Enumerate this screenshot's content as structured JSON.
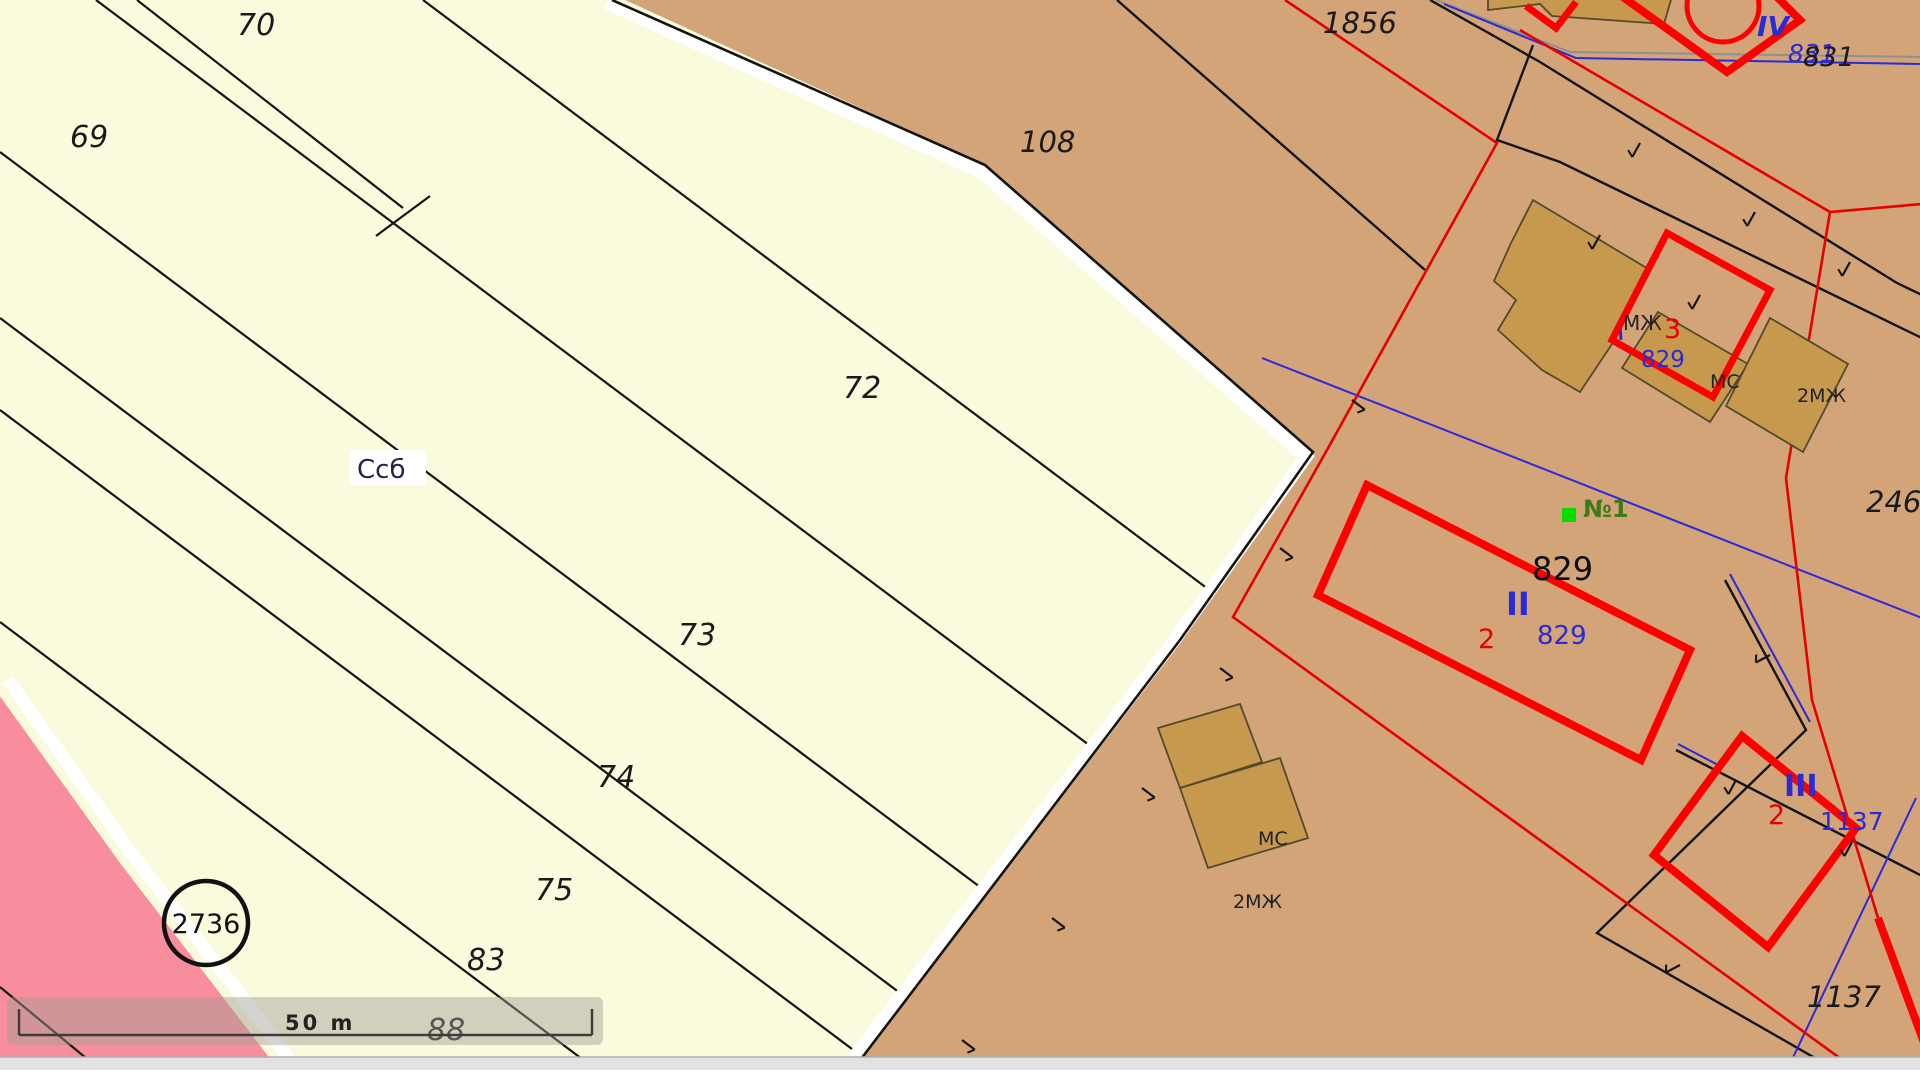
{
  "map": {
    "colors": {
      "cream": "#FAFADC",
      "brown": "#D2A478",
      "pink": "#F78D9D",
      "tan_fill": "#C6994F",
      "tan_outline": "#55492C",
      "red_thick": "#FF0000",
      "red_thin": "#E60000",
      "blue": "#2A2AD8",
      "gray": "#909090",
      "black": "#141414",
      "white": "#FFFFFF",
      "green_marker": "#00DD00",
      "green_text": "#3F7A1A",
      "scrollbar_track": "#E2E2E2",
      "scrollbar_border": "#ADADAD"
    },
    "regions": {
      "brown_polygon": [
        [
          612,
          -6
        ],
        [
          1926,
          -6
        ],
        [
          1926,
          1086
        ],
        [
          838,
          1086
        ],
        [
          1180,
          640
        ],
        [
          1313,
          452
        ],
        [
          985,
          165
        ]
      ],
      "pink_polygon": [
        [
          -6,
          688
        ],
        [
          120,
          863
        ],
        [
          268,
          1056
        ],
        [
          292,
          1086
        ],
        [
          -6,
          1086
        ]
      ]
    },
    "white_bands": [
      {
        "name": "brown-edge-gap",
        "pts": [
          [
            607,
            3
          ],
          [
            981,
            172
          ],
          [
            1306,
            457
          ],
          [
            1173,
            642
          ],
          [
            834,
            1083
          ]
        ],
        "w": 13
      },
      {
        "name": "pink-edge-gap",
        "pts": [
          [
            8,
            680
          ],
          [
            132,
            854
          ],
          [
            280,
            1046
          ],
          [
            302,
            1083
          ]
        ],
        "w": 13
      }
    ],
    "boundary_black": {
      "pts": [
        [
          612,
          0
        ],
        [
          985,
          165
        ],
        [
          1313,
          452
        ],
        [
          1180,
          640
        ],
        [
          845,
          1080
        ]
      ],
      "w": 2.6
    },
    "cream_lines": [
      {
        "pts": [
          [
            137,
            0
          ],
          [
            403,
            208
          ]
        ]
      },
      {
        "pts": [
          [
            430,
            196
          ],
          [
            376,
            236
          ]
        ]
      },
      {
        "pts": [
          [
            423,
            0
          ],
          [
            1320,
            673
          ]
        ]
      },
      {
        "pts": [
          [
            96,
            0
          ],
          [
            1185,
            817
          ]
        ]
      },
      {
        "pts": [
          [
            0,
            152
          ],
          [
            1120,
            992
          ]
        ]
      },
      {
        "pts": [
          [
            0,
            318
          ],
          [
            1020,
            1083
          ]
        ]
      },
      {
        "pts": [
          [
            0,
            410
          ],
          [
            900,
            1085
          ]
        ]
      },
      {
        "pts": [
          [
            0,
            622
          ],
          [
            618,
            1086
          ]
        ]
      },
      {
        "pts": [
          [
            0,
            987
          ],
          [
            115,
            1082
          ]
        ]
      }
    ],
    "brown_black_lines": [
      {
        "pts": [
          [
            1117,
            0
          ],
          [
            1425,
            270
          ]
        ]
      },
      {
        "pts": [
          [
            1430,
            0
          ],
          [
            1540,
            62
          ],
          [
            1897,
            283
          ],
          [
            1926,
            297
          ]
        ]
      },
      {
        "pts": [
          [
            1533,
            45
          ],
          [
            1497,
            140
          ],
          [
            1560,
            162
          ],
          [
            1926,
            340
          ]
        ]
      },
      {
        "pts": [
          [
            1725,
            580
          ],
          [
            1806,
            730
          ],
          [
            1597,
            933
          ],
          [
            1815,
            1058
          ],
          [
            1892,
            1086
          ]
        ]
      },
      {
        "pts": [
          [
            1676,
            750
          ],
          [
            1926,
            878
          ]
        ]
      }
    ],
    "red_buildings": [
      {
        "name": "building-II-outline",
        "pts": [
          [
            1367,
            485
          ],
          [
            1690,
            650
          ],
          [
            1641,
            760
          ],
          [
            1318,
            595
          ]
        ],
        "closed": true,
        "w": 8
      },
      {
        "name": "building-III-outline",
        "pts": [
          [
            1742,
            736
          ],
          [
            1856,
            828
          ],
          [
            1768,
            947
          ],
          [
            1654,
            855
          ]
        ],
        "closed": true,
        "w": 8
      },
      {
        "name": "building-3-outline",
        "pts": [
          [
            1667,
            233
          ],
          [
            1770,
            290
          ],
          [
            1713,
            397
          ],
          [
            1612,
            340
          ]
        ],
        "closed": true,
        "w": 7
      },
      {
        "name": "building-IV-outline",
        "pts": [
          [
            1616,
            -8
          ],
          [
            1727,
            72
          ],
          [
            1800,
            20
          ],
          [
            1758,
            -22
          ]
        ],
        "closed": false,
        "w": 8
      },
      {
        "name": "red-corner",
        "pts": [
          [
            1526,
            6
          ],
          [
            1556,
            28
          ],
          [
            1576,
            2
          ]
        ],
        "closed": false,
        "w": 7
      },
      {
        "name": "red-corner-bottom-right",
        "pts": [
          [
            1878,
            918
          ],
          [
            1926,
            1048
          ]
        ],
        "closed": false,
        "w": 8
      }
    ],
    "red_thin_lines": [
      {
        "pts": [
          [
            1285,
            0
          ],
          [
            1497,
            143
          ],
          [
            1327,
            450
          ],
          [
            1233,
            617
          ],
          [
            1870,
            1080
          ]
        ]
      },
      {
        "pts": [
          [
            1520,
            30
          ],
          [
            1830,
            212
          ],
          [
            1922,
            204
          ]
        ]
      },
      {
        "pts": [
          [
            1830,
            212
          ],
          [
            1786,
            478
          ],
          [
            1812,
            700
          ],
          [
            1878,
            918
          ]
        ]
      }
    ],
    "red_circle": {
      "cx": 1723,
      "cy": 6,
      "r": 36,
      "w": 5
    },
    "blue_lines": [
      {
        "pts": [
          [
            1444,
            4
          ],
          [
            1576,
            58
          ],
          [
            1922,
            64
          ]
        ],
        "w": 2
      },
      {
        "pts": [
          [
            1262,
            358
          ],
          [
            1922,
            618
          ]
        ],
        "w": 2
      },
      {
        "pts": [
          [
            1916,
            798
          ],
          [
            1780,
            1085
          ]
        ],
        "w": 2
      },
      {
        "pts": [
          [
            1678,
            744
          ],
          [
            1720,
            766
          ]
        ],
        "w": 2
      },
      {
        "pts": [
          [
            1730,
            574
          ],
          [
            1810,
            722
          ]
        ],
        "w": 2
      },
      {
        "pts": [
          [
            1619,
            308
          ],
          [
            1621,
            340
          ]
        ],
        "w": 3
      }
    ],
    "gray_lines": [
      {
        "pts": [
          [
            1436,
            0
          ],
          [
            1570,
            52
          ],
          [
            1922,
            57
          ]
        ],
        "w": 2
      }
    ],
    "tan_buildings": [
      {
        "name": "building-footprint-top",
        "pts": [
          [
            1488,
            -4
          ],
          [
            1672,
            -4
          ],
          [
            1664,
            24
          ],
          [
            1552,
            16
          ],
          [
            1540,
            4
          ],
          [
            1488,
            10
          ]
        ]
      },
      {
        "name": "building-footprint-large",
        "pts": [
          [
            1533,
            200
          ],
          [
            1650,
            270
          ],
          [
            1612,
            344
          ],
          [
            1580,
            392
          ],
          [
            1542,
            370
          ],
          [
            1498,
            330
          ],
          [
            1516,
            300
          ],
          [
            1494,
            281
          ],
          [
            1511,
            243
          ]
        ]
      },
      {
        "name": "building-footprint-mid",
        "pts": [
          [
            1658,
            312
          ],
          [
            1748,
            364
          ],
          [
            1710,
            422
          ],
          [
            1622,
            368
          ]
        ]
      },
      {
        "name": "building-footprint-right",
        "pts": [
          [
            1770,
            318
          ],
          [
            1848,
            364
          ],
          [
            1803,
            452
          ],
          [
            1726,
            406
          ]
        ]
      },
      {
        "name": "building-footprint-south-a",
        "pts": [
          [
            1158,
            728
          ],
          [
            1240,
            704
          ],
          [
            1262,
            762
          ],
          [
            1180,
            788
          ]
        ]
      },
      {
        "name": "building-footprint-south-b",
        "pts": [
          [
            1180,
            788
          ],
          [
            1280,
            758
          ],
          [
            1308,
            838
          ],
          [
            1208,
            868
          ]
        ]
      }
    ],
    "fence_ticks": [
      [
        1352,
        400,
        37
      ],
      [
        1280,
        548,
        37
      ],
      [
        1220,
        668,
        37
      ],
      [
        1142,
        788,
        37
      ],
      [
        1052,
        918,
        37
      ],
      [
        962,
        1040,
        37
      ],
      [
        1640,
        143,
        119
      ],
      [
        1755,
        212,
        119
      ],
      [
        1600,
        235,
        119
      ],
      [
        1700,
        295,
        119
      ],
      [
        1850,
        262,
        119
      ],
      [
        1770,
        655,
        152
      ],
      [
        1680,
        965,
        152
      ],
      [
        1736,
        780,
        118
      ],
      [
        1852,
        842,
        118
      ]
    ],
    "labels": [
      {
        "id": "parcel-69",
        "text": "69",
        "x": 70,
        "y": 147,
        "size": 30,
        "color": "#1a1a1a",
        "italic": true
      },
      {
        "id": "parcel-70",
        "text": "70",
        "x": 237,
        "y": 35,
        "size": 30,
        "color": "#1a1a1a",
        "italic": true
      },
      {
        "id": "parcel-72",
        "text": "72",
        "x": 843,
        "y": 398,
        "size": 30,
        "color": "#1a1a1a",
        "italic": true
      },
      {
        "id": "parcel-73",
        "text": "73",
        "x": 678,
        "y": 645,
        "size": 30,
        "color": "#1a1a1a",
        "italic": true
      },
      {
        "id": "parcel-74",
        "text": "74",
        "x": 597,
        "y": 787,
        "size": 30,
        "color": "#1a1a1a",
        "italic": true
      },
      {
        "id": "parcel-75",
        "text": "75",
        "x": 535,
        "y": 900,
        "size": 30,
        "color": "#1a1a1a",
        "italic": true
      },
      {
        "id": "parcel-83",
        "text": "83",
        "x": 467,
        "y": 970,
        "size": 30,
        "color": "#1a1a1a",
        "italic": true
      },
      {
        "id": "parcel-88",
        "text": "88",
        "x": 427,
        "y": 1040,
        "size": 30,
        "color": "#1a1a1a",
        "italic": true
      },
      {
        "id": "parcel-108",
        "text": "108",
        "x": 1020,
        "y": 152,
        "size": 29,
        "color": "#1a1a1a",
        "italic": true
      },
      {
        "id": "parcel-1856",
        "text": "1856",
        "x": 1323,
        "y": 33,
        "size": 29,
        "color": "#1a1a1a",
        "italic": true
      },
      {
        "id": "parcel-246",
        "text": "246",
        "x": 1866,
        "y": 512,
        "size": 29,
        "color": "#1a1a1a",
        "italic": true
      },
      {
        "id": "parcel-1137-black",
        "text": "1137",
        "x": 1807,
        "y": 1007,
        "size": 29,
        "color": "#1a1a1a",
        "italic": true
      },
      {
        "id": "parcel-831-blue",
        "text": "831",
        "x": 1788,
        "y": 62,
        "size": 25,
        "color": "#2A2AD8",
        "italic": true
      },
      {
        "id": "parcel-831-black",
        "text": "831",
        "x": 1803,
        "y": 66,
        "size": 27,
        "color": "#1a1a1a",
        "italic": true
      },
      {
        "id": "building-IV",
        "text": "IV",
        "x": 1757,
        "y": 36,
        "size": 28,
        "color": "#2A2AD8",
        "italic": true,
        "bold": true
      },
      {
        "id": "label-mj",
        "text": "МЖ",
        "x": 1623,
        "y": 330,
        "size": 20,
        "color": "#222222"
      },
      {
        "id": "building-3-red",
        "text": "3",
        "x": 1664,
        "y": 338,
        "size": 27,
        "color": "#E80000"
      },
      {
        "id": "parcel-829-blue-a",
        "text": "829",
        "x": 1641,
        "y": 367,
        "size": 23,
        "color": "#2A2AD8"
      },
      {
        "id": "label-mc",
        "text": "МС",
        "x": 1710,
        "y": 388,
        "size": 19,
        "color": "#222222"
      },
      {
        "id": "label-2mj",
        "text": "2МЖ",
        "x": 1797,
        "y": 402,
        "size": 19,
        "color": "#222222"
      },
      {
        "id": "address-n1",
        "text": "№1",
        "x": 1583,
        "y": 517,
        "size": 24,
        "color": "#3F7A1A",
        "bold": true
      },
      {
        "id": "parcel-829-black",
        "text": "829",
        "x": 1532,
        "y": 580,
        "size": 32,
        "color": "#0d0d0d"
      },
      {
        "id": "building-II",
        "text": "II",
        "x": 1506,
        "y": 615,
        "size": 32,
        "color": "#2A2AD8",
        "bold": true
      },
      {
        "id": "building-2-red-a",
        "text": "2",
        "x": 1478,
        "y": 648,
        "size": 27,
        "color": "#E80000"
      },
      {
        "id": "parcel-829-blue-b",
        "text": "829",
        "x": 1537,
        "y": 644,
        "size": 26,
        "color": "#2A2AD8"
      },
      {
        "id": "building-III",
        "text": "III",
        "x": 1784,
        "y": 796,
        "size": 30,
        "color": "#2A2AD8",
        "bold": true
      },
      {
        "id": "building-2-red-b",
        "text": "2",
        "x": 1768,
        "y": 824,
        "size": 27,
        "color": "#E80000"
      },
      {
        "id": "parcel-1137-blue",
        "text": "1137",
        "x": 1820,
        "y": 830,
        "size": 25,
        "color": "#2A2AD8"
      },
      {
        "id": "label-mc-south",
        "text": "МС",
        "x": 1258,
        "y": 845,
        "size": 19,
        "color": "#222222"
      },
      {
        "id": "label-2mj-south",
        "text": "2МЖ",
        "x": 1233,
        "y": 908,
        "size": 19,
        "color": "#222222"
      }
    ],
    "ssb_label": {
      "text": "Ссб",
      "x": 357,
      "y": 478,
      "size": 26,
      "color": "#25254A",
      "box": [
        350,
        450,
        76,
        35
      ]
    },
    "circle_label": {
      "text": "2736",
      "cx": 206,
      "cy": 923,
      "r": 42,
      "stroke_w": 4.5,
      "size": 27,
      "color": "#111111"
    },
    "green_marker": {
      "x": 1562,
      "y": 508,
      "size": 14
    },
    "scale_bar": {
      "box": [
        7,
        997,
        596,
        48
      ],
      "box_fill": "rgba(160,158,148,0.45)",
      "line": {
        "x1": 19,
        "x2": 592,
        "y": 1035,
        "w": 2.5,
        "color": "#3C3C3C"
      },
      "tick_height": 26,
      "label": "50 m",
      "label_x": 285,
      "label_y": 1030,
      "label_size": 21,
      "label_color": "#222222"
    },
    "scrollbar": {
      "y": 1057,
      "track_h": 13,
      "white_h": 10
    }
  }
}
